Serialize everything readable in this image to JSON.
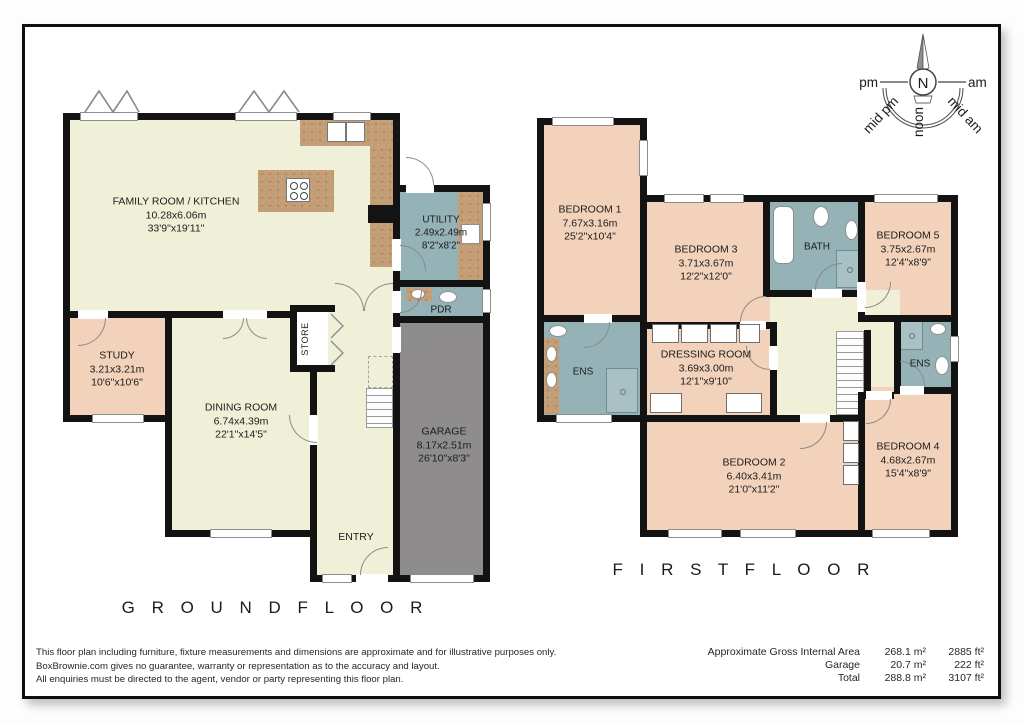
{
  "compass": {
    "north": "N",
    "am": "am",
    "pm": "pm",
    "mid_am": "mid am",
    "mid_pm": "mid pm",
    "noon": "noon"
  },
  "floors": {
    "ground": {
      "caption": "G R O U N D   F L O O R"
    },
    "first": {
      "caption": "F I R S T   F L O O R"
    }
  },
  "rooms": {
    "family": {
      "name": "FAMILY ROOM / KITCHEN",
      "metric": "10.28x6.06m",
      "imperial": "33'9\"x19'11\""
    },
    "utility": {
      "name": "UTILITY",
      "metric": "2.49x2.49m",
      "imperial": "8'2\"x8'2\""
    },
    "pdr": {
      "name": "PDR"
    },
    "study": {
      "name": "STUDY",
      "metric": "3.21x3.21m",
      "imperial": "10'6\"x10'6\""
    },
    "dining": {
      "name": "DINING ROOM",
      "metric": "6.74x4.39m",
      "imperial": "22'1\"x14'5\""
    },
    "store": {
      "name": "STORE"
    },
    "entry": {
      "name": "ENTRY"
    },
    "garage": {
      "name": "GARAGE",
      "metric": "8.17x2.51m",
      "imperial": "26'10\"x8'3\""
    },
    "bedroom1": {
      "name": "BEDROOM 1",
      "metric": "7.67x3.16m",
      "imperial": "25'2\"x10'4\""
    },
    "bedroom2": {
      "name": "BEDROOM 2",
      "metric": "6.40x3.41m",
      "imperial": "21'0\"x11'2\""
    },
    "bedroom3": {
      "name": "BEDROOM 3",
      "metric": "3.71x3.67m",
      "imperial": "12'2\"x12'0\""
    },
    "bedroom4": {
      "name": "BEDROOM 4",
      "metric": "4.68x2.67m",
      "imperial": "15'4\"x8'9\""
    },
    "bedroom5": {
      "name": "BEDROOM 5",
      "metric": "3.75x2.67m",
      "imperial": "12'4\"x8'9\""
    },
    "bath": {
      "name": "BATH"
    },
    "ens_left": {
      "name": "ENS"
    },
    "ens_right": {
      "name": "ENS"
    },
    "dressing": {
      "name": "DRESSING ROOM",
      "metric": "3.69x3.00m",
      "imperial": "12'1\"x9'10\""
    }
  },
  "footer": {
    "disclaimer": [
      "This floor plan including furniture, fixture measurements and dimensions are approximate and for illustrative purposes only.",
      "BoxBrownie.com gives no guarantee, warranty or representation as to the accuracy and layout.",
      "All enquiries must be directed to the agent, vendor or party representing this floor plan."
    ],
    "areas": [
      {
        "label": "Approximate Gross Internal Area",
        "metric": "268.1 m²",
        "imperial": "2885 ft²"
      },
      {
        "label": "Garage",
        "metric": "20.7 m²",
        "imperial": "222 ft²"
      },
      {
        "label": "Total",
        "metric": "288.8 m²",
        "imperial": "3107 ft²"
      }
    ]
  },
  "colors": {
    "cream": "#f0f0d8",
    "salmon": "#f2d2bb",
    "blue": "#95b2b7",
    "garage": "#8e8c8d",
    "counter": "#c29d76",
    "wall": "#131313"
  }
}
